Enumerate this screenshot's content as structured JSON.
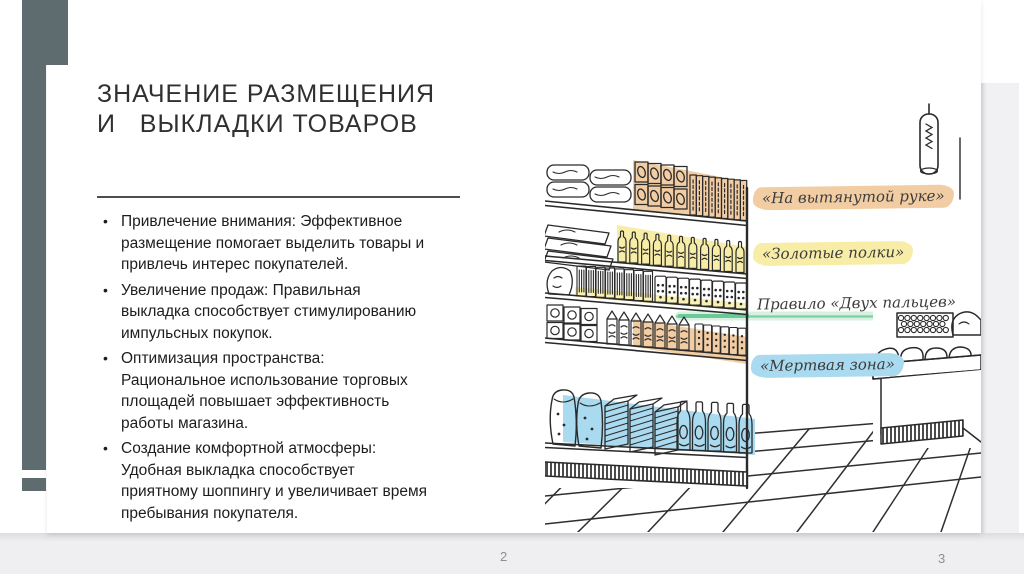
{
  "slide": {
    "title_line1": "ЗНАЧЕНИЕ РАЗМЕЩЕНИЯ",
    "title_line2": "И   ВЫКЛАДКИ ТОВАРОВ",
    "accent_color": "#5e6c6f",
    "bullets": [
      "Привлечение внимания: Эффективное размещение помогает выделить товары и привлечь интерес покупателей.",
      "Увеличение продаж: Правильная выкладка способствует стимулированию импульсных покупок.",
      "Оптимизация пространства: Рациональное использование торговых площадей повышает эффективность работы магазина.",
      "Создание комфортной атмосферы: Удобная выкладка способствует приятному шоппингу и увеличивает время пребывания покупателя."
    ],
    "illustration_labels": [
      {
        "text": "«На вытянутой руке»",
        "highlight": "#f2cda3"
      },
      {
        "text": "«Золотые полки»",
        "highlight": "#f7eda7"
      },
      {
        "text": "Правило «Двух пальцев»",
        "highlight": "transparent"
      },
      {
        "text": "«Мертвая зона»",
        "highlight": "#a9daef"
      }
    ],
    "illustration_colors": {
      "shelf_highlight_orange": "#f2cda3",
      "shelf_highlight_yellow": "#f7eda7",
      "shelf_highlight_blue": "#a9daef",
      "green_underline": "#7fd0a0"
    }
  },
  "viewer": {
    "page_numbers": [
      "2",
      "3"
    ]
  }
}
